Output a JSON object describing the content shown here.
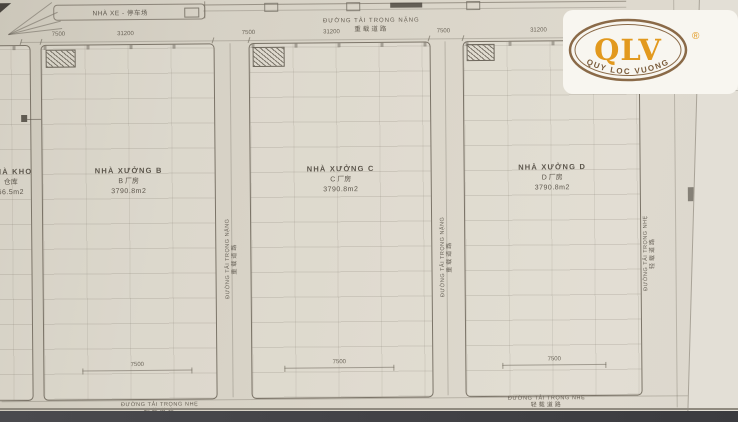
{
  "logo": {
    "abbr": "QLV",
    "registered": "®",
    "tagline": "QUY LOC VUONG",
    "colors": {
      "orange": "#E2991E",
      "ring_brown": "#8A6A48",
      "badge_bg": "#F8F6F0"
    }
  },
  "plan": {
    "parking": {
      "text": "NHÀ XE - 停车场"
    },
    "roads": {
      "top": {
        "vi": "ĐƯỜNG TẢI TRỌNG NẶNG",
        "cn": "重载道路"
      },
      "between_bc": {
        "vi": "ĐƯỜNG TẢI TRỌNG NẶNG",
        "cn": "重载道路"
      },
      "between_cd": {
        "vi": "ĐƯỜNG TẢI TRỌNG NẶNG",
        "cn": "重载道路"
      },
      "right": {
        "vi": "ĐƯỜNG TẢI TRỌNG NHẸ",
        "cn": "轻载道路"
      },
      "bottom_left": {
        "vi": "ĐƯỜNG TẢI TRỌNG NHẸ",
        "cn": "轻载道路"
      },
      "bottom_right": {
        "vi": "ĐƯỜNG TẢI TRỌNG NHẸ",
        "cn": "轻载道路"
      }
    },
    "buildings": {
      "kho": {
        "name_vi": "NHÀ KHO",
        "name_cn": "仓库",
        "area": "66.5m2"
      },
      "b": {
        "name_vi": "NHÀ XƯỞNG B",
        "name_cn": "B 厂房",
        "area": "3790.8m2"
      },
      "c": {
        "name_vi": "NHÀ XƯỞNG C",
        "name_cn": "C 厂房",
        "area": "3790.8m2"
      },
      "d": {
        "name_vi": "NHÀ XƯỞNG D",
        "name_cn": "D 厂房",
        "area": "3790.8m2"
      }
    },
    "dims": {
      "top": [
        "7500",
        "31200",
        "7500",
        "31200",
        "7500",
        "31200"
      ],
      "inner_width": "7500"
    },
    "colors": {
      "paper": "#D8D3C7",
      "ink": "#5C564C",
      "photo_band": "#424246"
    }
  }
}
